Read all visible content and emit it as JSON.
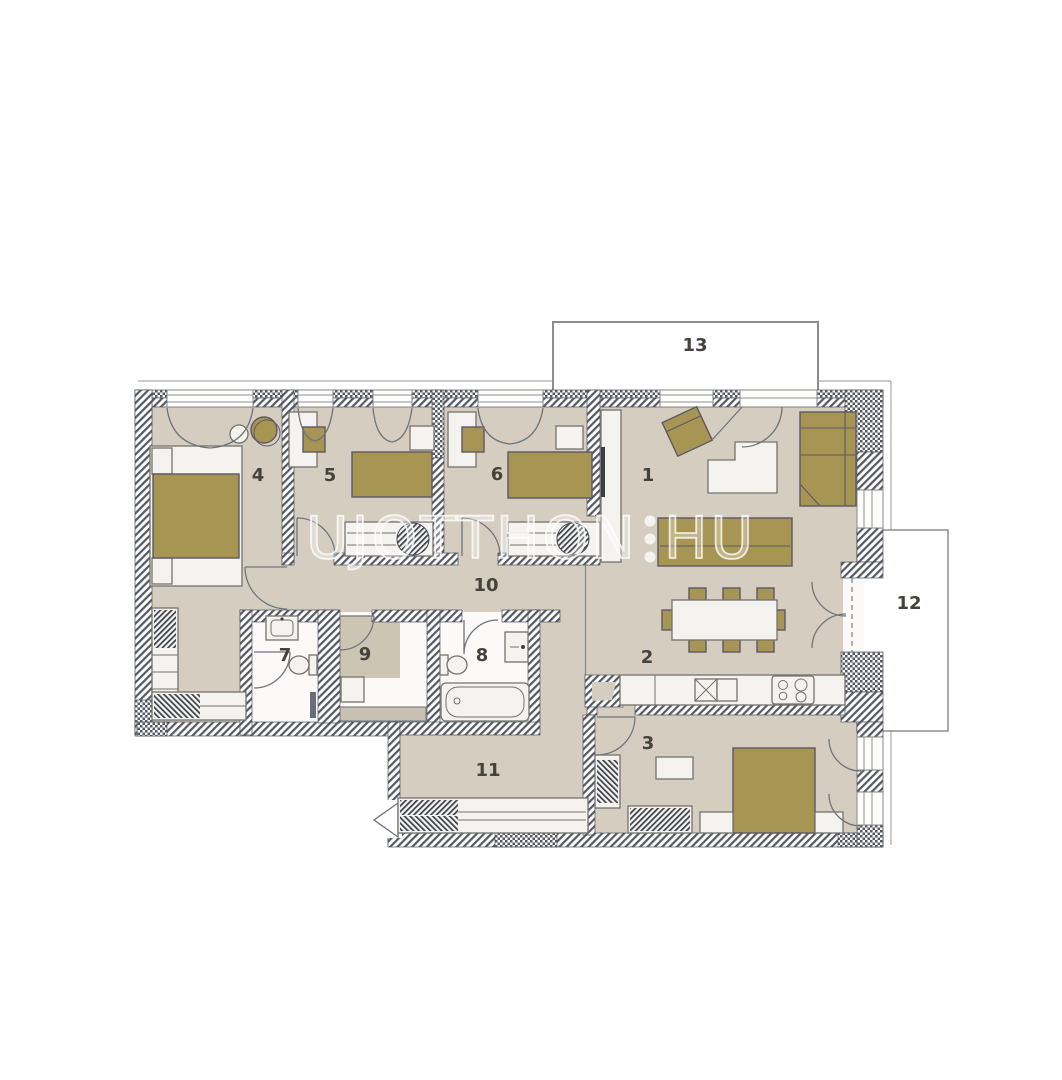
{
  "watermark": {
    "part1": "UJOTTHON",
    "part2": "HU"
  },
  "rooms": {
    "r1": "1",
    "r2": "2",
    "r3": "3",
    "r4": "4",
    "r5": "5",
    "r6": "6",
    "r7": "7",
    "r8": "8",
    "r9": "9",
    "r10": "10",
    "r11": "11",
    "r12": "12",
    "r13": "13"
  },
  "colors": {
    "floor": "#d5cec0",
    "floor_dark": "#cdc5b3",
    "furniture": "#a79554",
    "furniture_line": "#5d5864",
    "wall": "#4f545c",
    "fixture": "#f4f3ef",
    "fixture_line": "#75726b",
    "door": "#6f747b",
    "balcony": "#8d8d8d",
    "facade": "#ababab",
    "label": "#45423b"
  }
}
